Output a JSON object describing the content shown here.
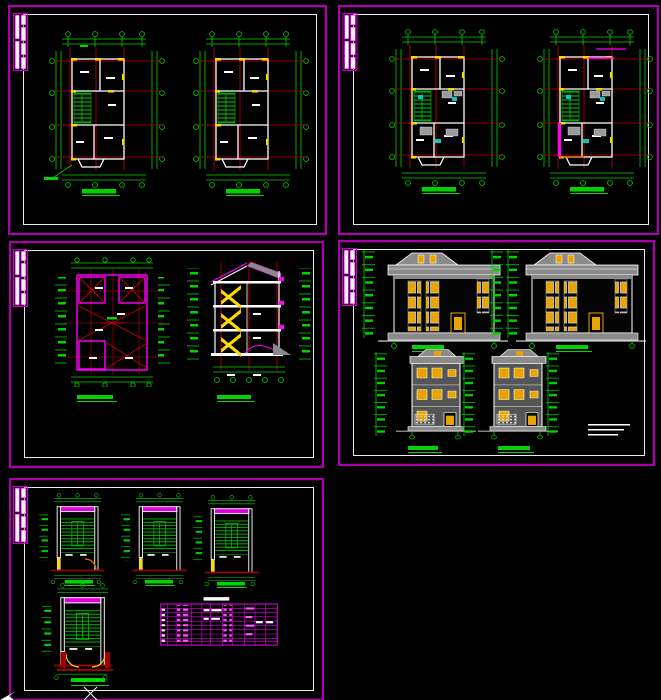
{
  "app": {
    "name": "cad-drawing-viewport",
    "background": "#000000",
    "cursor_tool": "crosshair"
  },
  "colors": {
    "sheet_border": "#ad00ad",
    "inner_border": "#ececec",
    "dimension_green": "#00d400",
    "grid_axis_red": "#c80000",
    "base_line_red": "#a00000",
    "wall_white": "#ffffff",
    "accent_yellow": "#ffd800",
    "window_yellow": "#e8a400",
    "door_orange": "#e07000",
    "roof_gray": "#8a8a8a",
    "facade_gray": "#555555",
    "magenta_element": "#ff00ff",
    "table_magenta": "#e000e0",
    "fixture_cyan": "#00c8c8",
    "fixture_gray": "#9a9a9a",
    "title_bar_green": "#00d400"
  },
  "sheets": [
    {
      "name": "floor-plan-sheet-1",
      "drawings": [
        "floor-plan-left",
        "floor-plan-right"
      ],
      "drawing_count": 2
    },
    {
      "name": "floor-plan-sheet-2",
      "drawings": [
        "floor-plan-left",
        "floor-plan-right"
      ],
      "drawing_count": 2
    },
    {
      "name": "roof-plan-and-section-sheet",
      "drawings": [
        "roof-plan",
        "building-section"
      ],
      "drawing_count": 2
    },
    {
      "name": "elevations-sheet",
      "drawings": [
        "side-elevation-left",
        "side-elevation-right",
        "front-elevation",
        "rear-elevation"
      ],
      "drawing_count": 4
    },
    {
      "name": "stair-details-sheet",
      "drawings": [
        "stair-detail-1",
        "stair-detail-2",
        "stair-detail-3",
        "stair-detail-4",
        "schedule-table"
      ],
      "drawing_count": 5
    }
  ],
  "cursor": {
    "type": "crosshair-x",
    "x": 90,
    "y": 693
  },
  "ucs_icon": {
    "type": "arrow",
    "x": 2,
    "y": 696
  }
}
